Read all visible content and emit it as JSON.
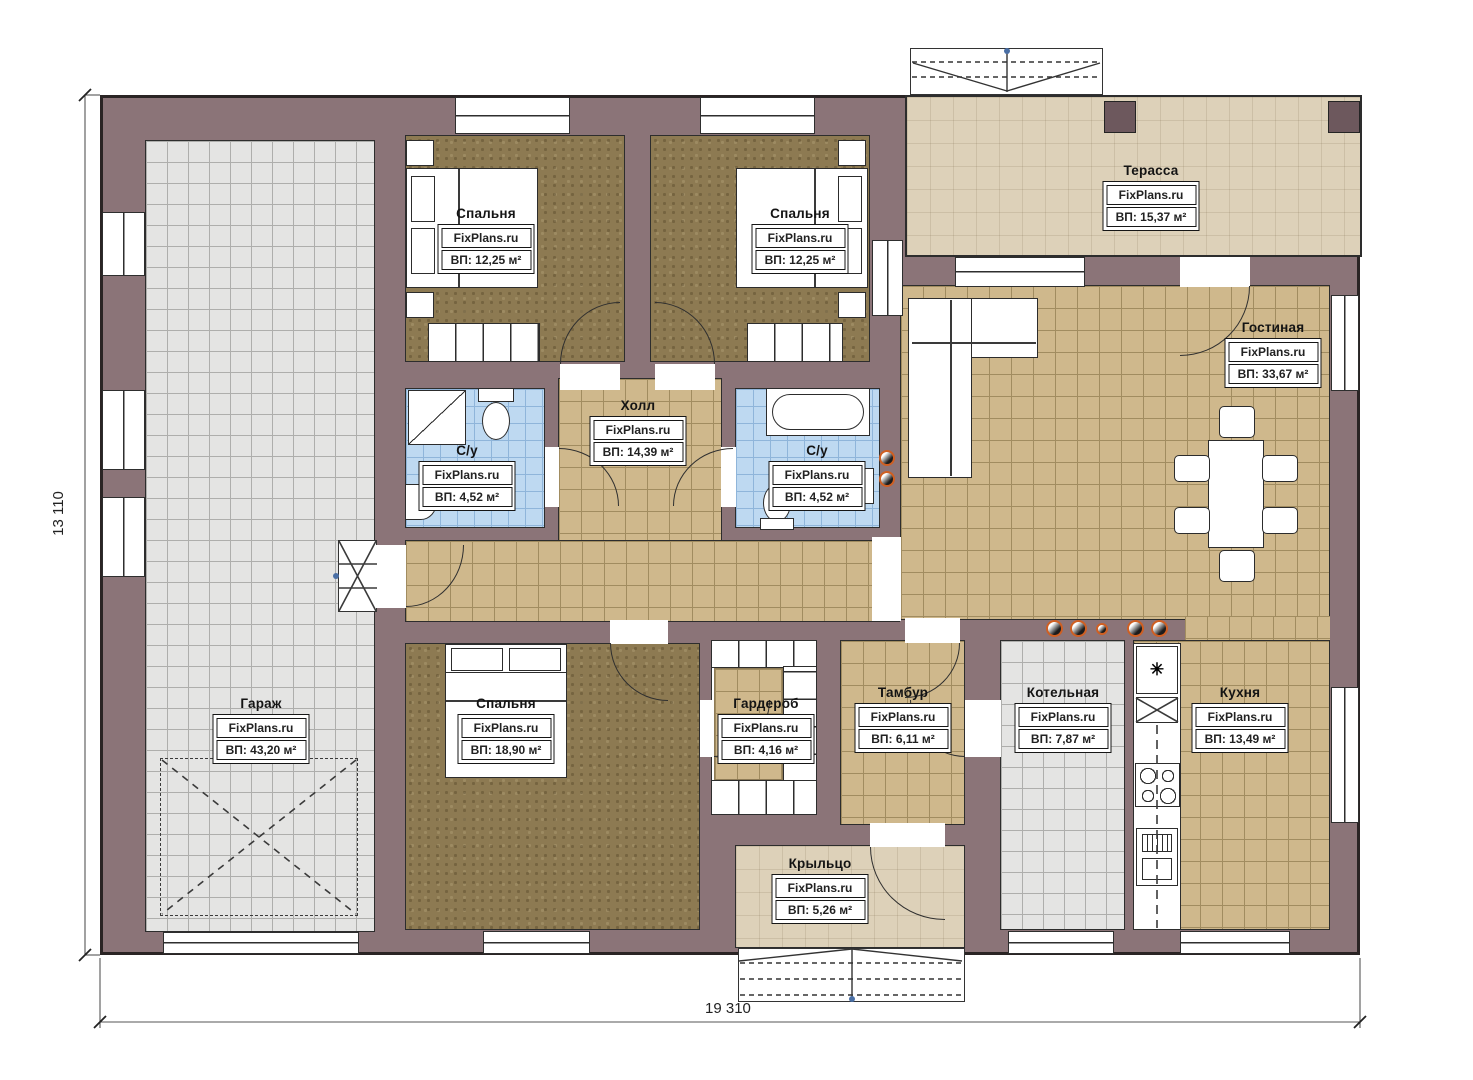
{
  "brand": "FixPlans.ru",
  "rooms": {
    "garage": {
      "name": "Гараж",
      "area": "ВП: 43,20 м²"
    },
    "bedroom1": {
      "name": "Спальня",
      "area": "ВП: 12,25 м²"
    },
    "bedroom2": {
      "name": "Спальня",
      "area": "ВП: 12,25 м²"
    },
    "terrace": {
      "name": "Терасса",
      "area": "ВП: 15,37 м²"
    },
    "living": {
      "name": "Гостиная",
      "area": "ВП: 33,67 м²"
    },
    "hall": {
      "name": "Холл",
      "area": "ВП: 14,39 м²"
    },
    "bath1": {
      "name": "С/у",
      "area": "ВП: 4,52 м²"
    },
    "bath2": {
      "name": "С/у",
      "area": "ВП: 4,52 м²"
    },
    "bedroom3": {
      "name": "Спальня",
      "area": "ВП: 18,90 м²"
    },
    "wardrobe": {
      "name": "Гардероб",
      "area": "ВП: 4,16 м²"
    },
    "tambur": {
      "name": "Тамбур",
      "area": "ВП: 6,11 м²"
    },
    "boiler": {
      "name": "Котельная",
      "area": "ВП: 7,87 м²"
    },
    "kitchen": {
      "name": "Кухня",
      "area": "ВП: 13,49 м²"
    },
    "porch": {
      "name": "Крыльцо",
      "area": "ВП: 5,26 м²"
    }
  },
  "dimensions": {
    "bottom": "19 310",
    "left": "13 110"
  },
  "icons": {
    "fridge": "✳"
  }
}
